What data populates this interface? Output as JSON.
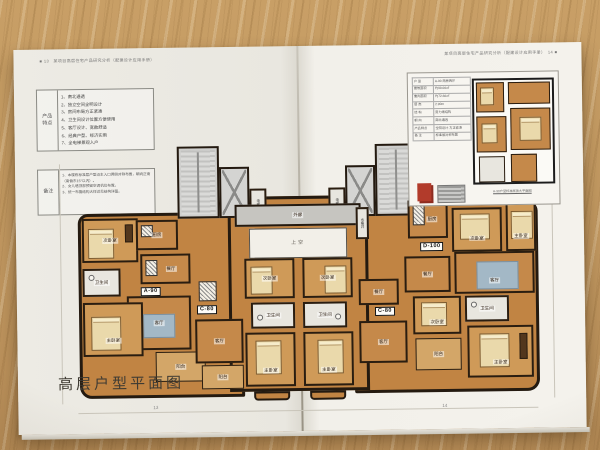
{
  "left_page": {
    "header": "■ 13　某项目高层住宅产品研究分析（配建设计应用手册）",
    "feature_table": {
      "label_line1": "产品",
      "label_line2": "特点",
      "items": [
        "1、南北通透",
        "2、独立空间全明设计",
        "3、房间布局方正紧凑",
        "4、卫生间设计位置方便使用",
        "5、客厅设计、宽敞舒适",
        "6、经典户型、经济实用",
        "7、全电梯景观入户"
      ]
    },
    "notes_table": {
      "label": "备注",
      "items": [
        "1、本楼栋标准层户型沿主入口两侧对称布置，朝向正南（南偏东15°以内）。",
        "2、女儿墙顶部预留空调机位布置。",
        "3、统一布置结构大样详见结构详图。"
      ]
    },
    "title": "高层户型平面图",
    "page_number": "13"
  },
  "right_page": {
    "header": "某项目高层住宅产品研究分析（配建设计应用手册）　14 ■",
    "inset": {
      "rows": [
        [
          "户 型",
          "A-90 两房两厅"
        ],
        [
          "建筑面积",
          "约90.00㎡"
        ],
        [
          "套内面积",
          "约72.60㎡"
        ],
        [
          "层 高",
          "2.90m"
        ],
        [
          "结 构",
          "剪力墙结构"
        ],
        [
          "朝 向",
          "南北通透"
        ],
        [
          "产品特点",
          "全明设计·方正紧凑"
        ],
        [
          "备 注",
          "标准层对称布置"
        ]
      ],
      "caption": "A-90户型标准层放大平面图"
    },
    "page_number": "14"
  },
  "plan": {
    "units": {
      "a90": "A-90",
      "c80": "C-80",
      "d100": "D-100"
    },
    "labels": {
      "kitchen": "厨房",
      "bedroom2": "次卧室",
      "master": "主卧室",
      "bath": "卫生间",
      "living": "客厅",
      "dining": "餐厅",
      "balcony": "阳台",
      "elevator": "电梯",
      "corridor": "外廊",
      "void": "上空",
      "shaft": "水暖井"
    }
  },
  "colors": {
    "room_orange": "#c18443",
    "wall_dark": "#241a10",
    "core_grey": "#cbcbc9",
    "rug_blue": "#a3b8c6",
    "stamp_red": "#b23b2b",
    "wood": "#c49c63",
    "page": "#f0eee8"
  }
}
